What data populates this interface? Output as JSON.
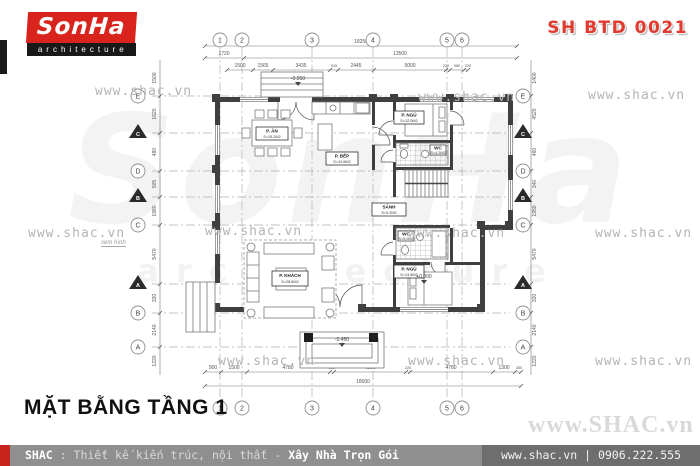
{
  "header": {
    "logo_brand": "SonHa",
    "logo_sub": "architecture",
    "code": "SH BTD 0021"
  },
  "watermarks": {
    "small": "www.shac.vn",
    "big": "www.SHAC.vn",
    "giant_brand": "SonHa",
    "giant_sub": "architecture"
  },
  "plan": {
    "title": "MẶT BẰNG TẦNG 1",
    "note": "xem hình",
    "grid": {
      "cols": [
        "1",
        "2",
        "3",
        "4",
        "5",
        "6"
      ],
      "rows": [
        "E",
        "D",
        "C",
        "B",
        "A"
      ],
      "sections": [
        "C",
        "B",
        "A"
      ]
    },
    "dims": {
      "top": [
        "1500",
        "1565",
        "3435",
        "515",
        "2445",
        "5000",
        "220",
        "980",
        "220"
      ],
      "top_mid": [
        "1720",
        "13500"
      ],
      "top_total": "18250",
      "bottom": [
        "900",
        "1500",
        "4780",
        "220",
        "4200",
        "220",
        "4780",
        "1300",
        "350"
      ],
      "bottom_total": "18000",
      "left": [
        "1500",
        "1620",
        "480",
        "505",
        "1980",
        "5470",
        "320",
        "2140",
        "1220"
      ],
      "right": [
        "1400",
        "4520",
        "460",
        "340",
        "1950",
        "5470",
        "320",
        "2140",
        "1220"
      ]
    },
    "rooms": [
      {
        "name": "P. ĂN",
        "area": "S=15.2M2"
      },
      {
        "name": "P. BẾP",
        "area": "S=12.6M2"
      },
      {
        "name": "P. KHÁCH",
        "area": "S=28.6M2"
      },
      {
        "name": "P. NGỦ",
        "area": "S=12.0M2"
      },
      {
        "name": "SẢNH",
        "area": "S=9.2M2"
      },
      {
        "name": "WC",
        "area": "S=4.2M2"
      },
      {
        "name": "WC",
        "area": "S=5.0M2"
      },
      {
        "name": "P. NGỦ",
        "area": "S=13.5M2"
      }
    ],
    "levels": {
      "entry": "-0.050",
      "hall": "+0.000",
      "porch": "-0.450"
    }
  },
  "footer": {
    "brand": "SHAC",
    "colon": ":",
    "tagline": "Thiết kế kiến trúc, nội thất",
    "dash": "-",
    "highlight": "Xây Nhà Trọn Gói",
    "site": "www.shac.vn",
    "divider": "|",
    "phone": "0906.222.555"
  }
}
